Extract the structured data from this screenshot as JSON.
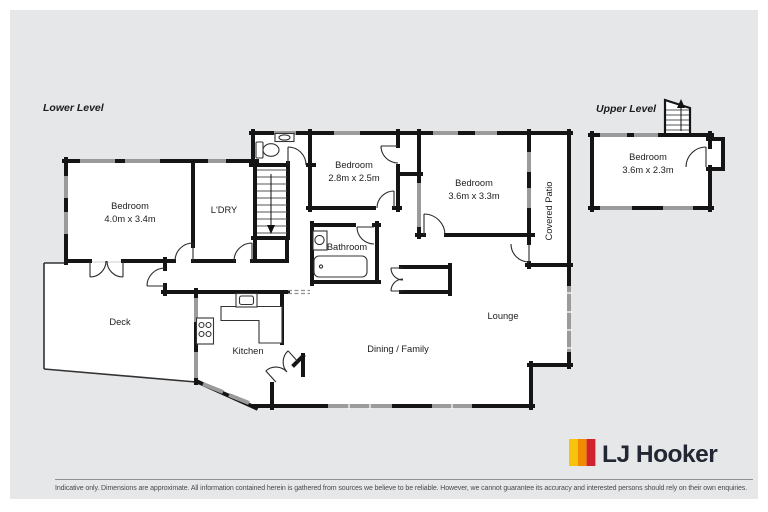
{
  "page": {
    "background": "#ffffff",
    "panel_bg": "#e6e7e9"
  },
  "floorplan": {
    "lower_level_label": "Lower Level",
    "upper_level_label": "Upper Level",
    "rooms": {
      "bedroom_main": {
        "name": "Bedroom",
        "dims": "4.0m x 3.4m"
      },
      "laundry": {
        "name": "L'DRY"
      },
      "bedroom_middle": {
        "name": "Bedroom",
        "dims": "2.8m x 2.5m"
      },
      "bedroom_right": {
        "name": "Bedroom",
        "dims": "3.6m x 3.3m"
      },
      "covered_patio": {
        "name": "Covered Patio"
      },
      "bathroom": {
        "name": "Bathroom"
      },
      "deck": {
        "name": "Deck"
      },
      "kitchen": {
        "name": "Kitchen"
      },
      "dining_family": {
        "name": "Dining / Family"
      },
      "lounge": {
        "name": "Lounge"
      },
      "bedroom_upper": {
        "name": "Bedroom",
        "dims": "3.6m x 2.3m"
      }
    }
  },
  "branding": {
    "logo_text": "LJ Hooker",
    "stripe_colors": [
      "#F9C20D",
      "#F08A00",
      "#D0232E"
    ],
    "text_color": "#232733"
  },
  "footer": {
    "disclaimer": "Indicative only. Dimensions are approximate. All information contained herein is gathered from sources we believe to be reliable. However, we cannot guarantee its accuracy and interested persons should rely on their own enquiries."
  }
}
